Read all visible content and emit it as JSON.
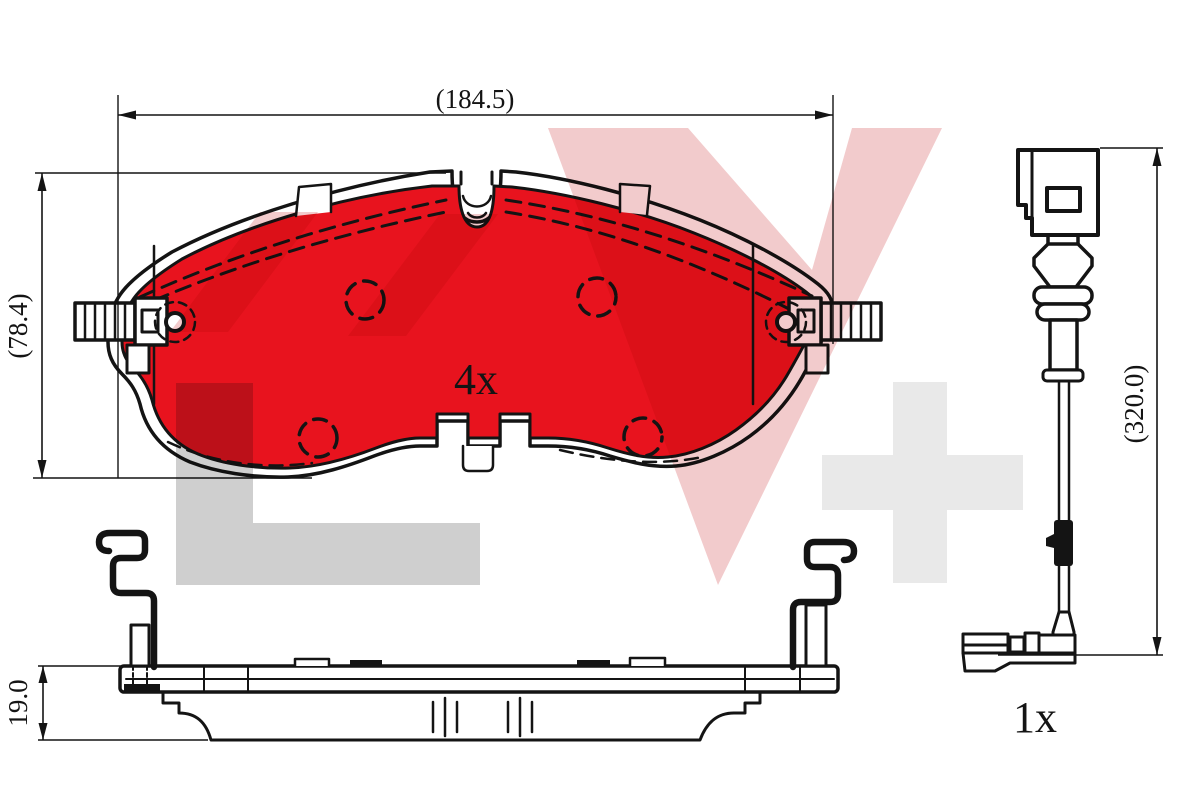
{
  "title": "Brake pad set technical drawing",
  "labels": {
    "pad_width_dim": "(184.5)",
    "pad_height_dim": "(78.4)",
    "pad_thickness_dim": "19.0",
    "sensor_length_dim": "(320.0)",
    "pad_quantity": "4x",
    "sensor_quantity": "1x"
  },
  "colors": {
    "pad_red": "#e8131e",
    "line": "#141414",
    "watermark_pink": "#f2cbcc",
    "watermark_gray": "#cfcfcf",
    "watermark_light_gray": "#e9e9e9",
    "background": "#ffffff"
  }
}
